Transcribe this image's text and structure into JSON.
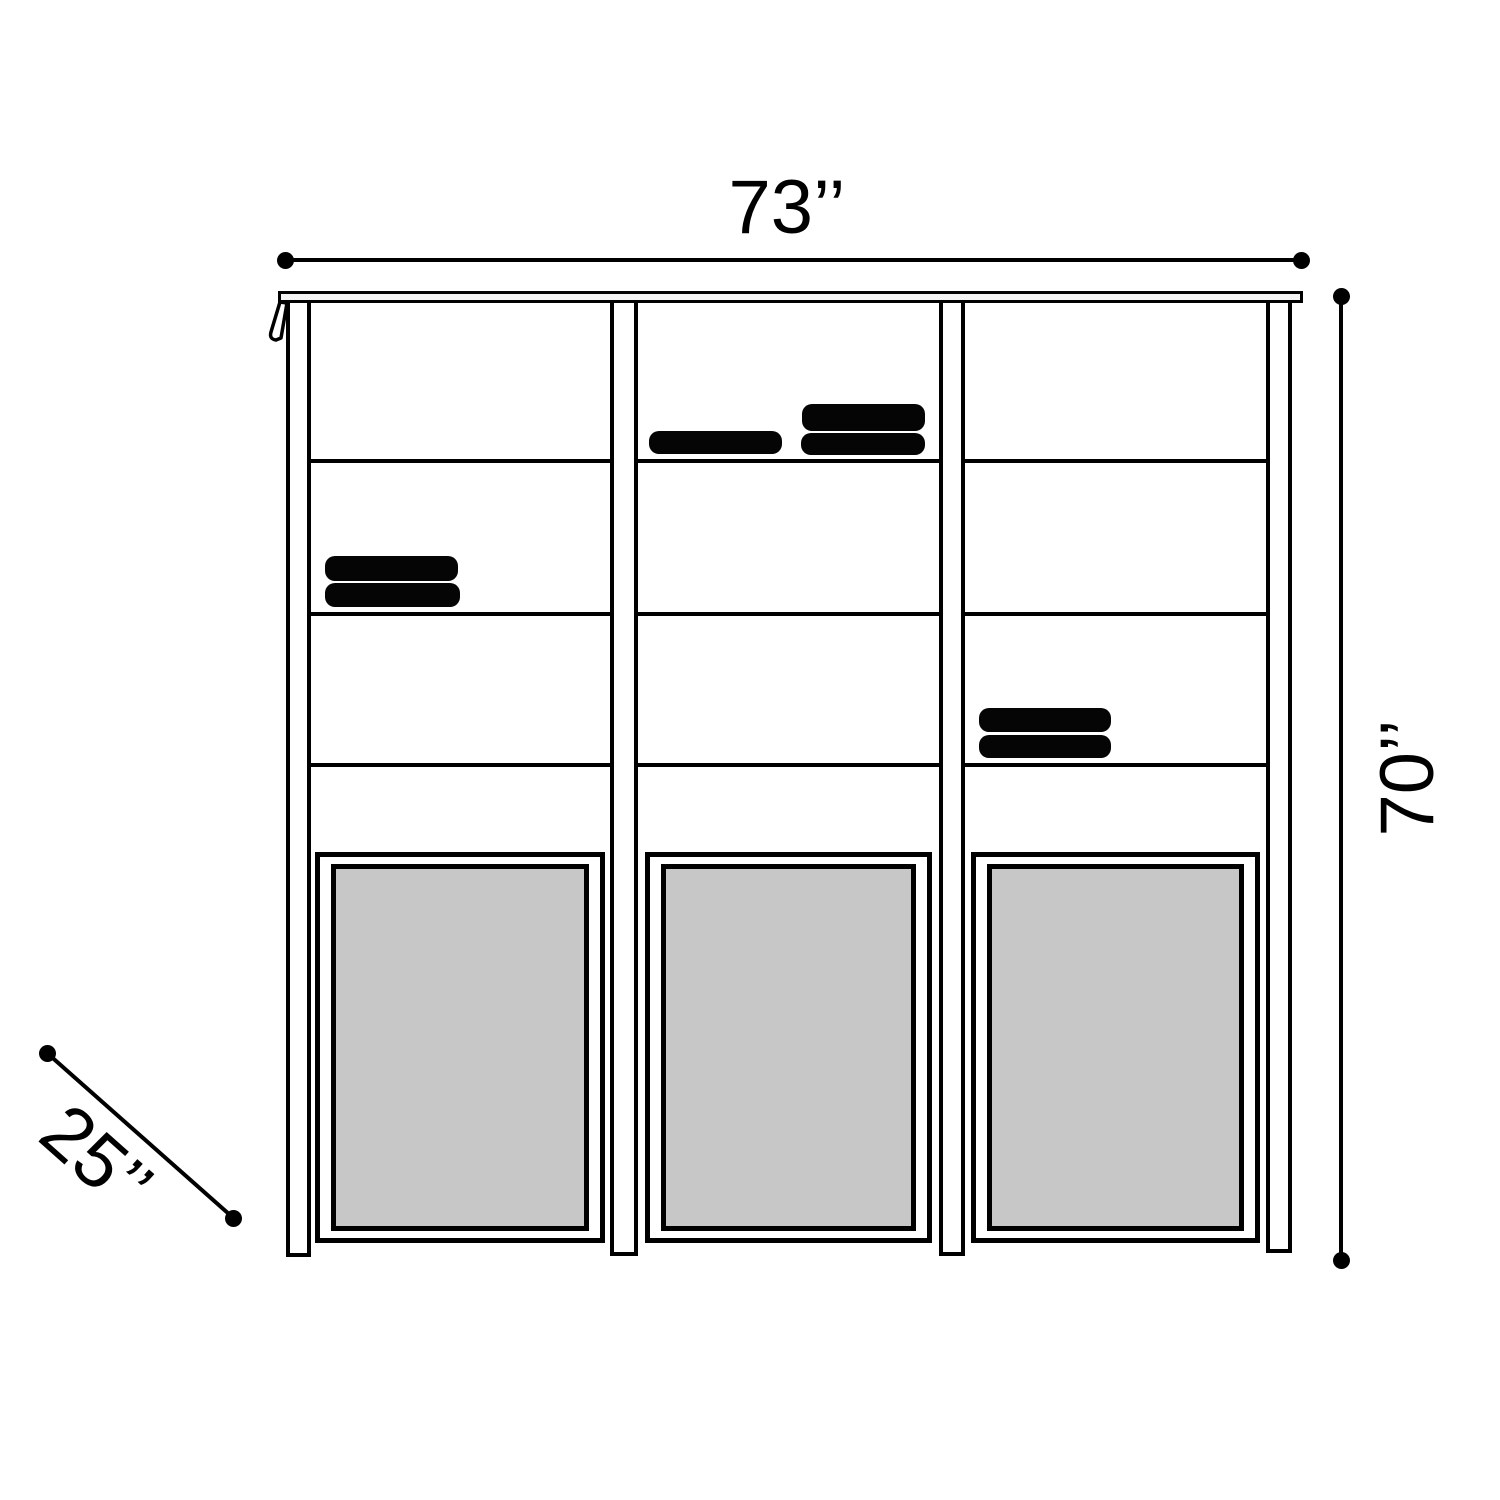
{
  "diagram": {
    "type": "furniture-dimension-diagram",
    "dimensions": {
      "width": {
        "label": "73’’"
      },
      "height": {
        "label": "70’’"
      },
      "depth": {
        "label": "25’’"
      }
    },
    "colors": {
      "line": "#000000",
      "door_panel_fill": "#c7c7c7",
      "background": "#ffffff"
    }
  }
}
